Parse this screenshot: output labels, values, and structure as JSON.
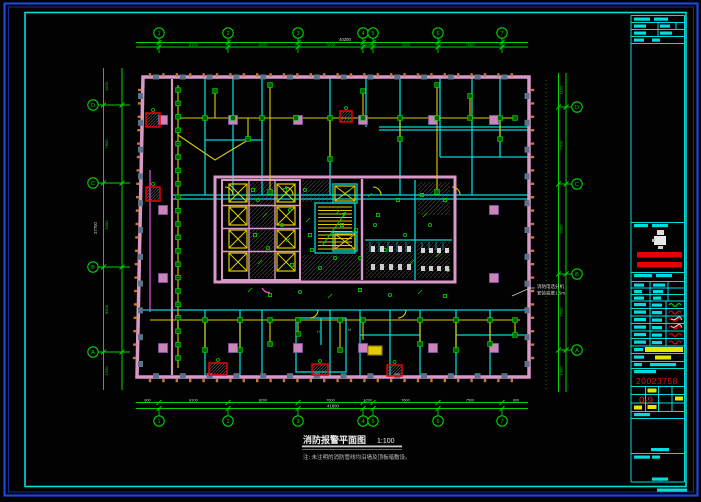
{
  "app": {
    "type": "cad-floor-plan-viewer"
  },
  "axes": {
    "top_bubbles": [
      "1",
      "2",
      "3",
      "4",
      "5",
      "6",
      "7"
    ],
    "bottom_bubbles": [
      "1",
      "2",
      "3",
      "4",
      "5",
      "6",
      "7"
    ],
    "left_bubbles": [
      "D",
      "C",
      "B",
      "A"
    ],
    "right_bubbles": [
      "D",
      "C",
      "B",
      "A"
    ],
    "top_dims": [
      "8100",
      "8200",
      "7600",
      "1200",
      "7600",
      "7500"
    ],
    "top_total": "40200",
    "bottom_dims": [
      "8100",
      "8200",
      "7600",
      "1200",
      "7600",
      "7500"
    ],
    "edge_dims": [
      "800",
      "800"
    ],
    "bottom_total": "41800",
    "left_dims": [
      "1500",
      "7800",
      "8400",
      "8500",
      "1500"
    ],
    "left_total": "27700",
    "right_dims": [
      "1150",
      "7700",
      "9000",
      "7600",
      "1400"
    ]
  },
  "annotation": {
    "line1": "消防电话分机",
    "line2": "安装高度1.5m"
  },
  "footer": {
    "title": "消防报警平面图",
    "scale": "1:100",
    "note": "注: 未注明的消防管线均沿墙及顶板暗敷设。"
  },
  "title_block": {
    "drawing_no": "0-9",
    "serial": "20023758"
  },
  "plan_labels": [
    {
      "text": "H",
      "x": 317,
      "y": 333
    },
    {
      "text": "M",
      "x": 348,
      "y": 331
    }
  ]
}
